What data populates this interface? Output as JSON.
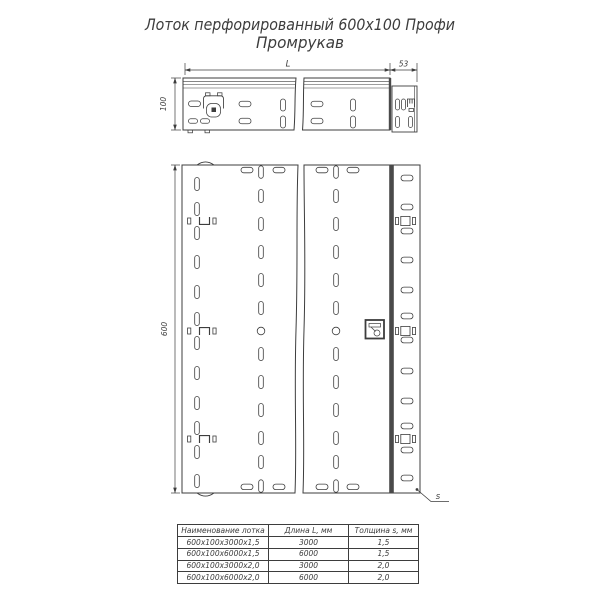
{
  "title": {
    "line1": "Лоток перфорированный 600х100 Профи",
    "line2": "Промрукав"
  },
  "dimensions": {
    "length_label": "L",
    "end_width": "53",
    "height": "100",
    "width": "600",
    "thickness_label": "s"
  },
  "table": {
    "headers": [
      "Наименование лотка",
      "Длина L, мм",
      "Толщина s, мм"
    ],
    "rows": [
      [
        "600х100х3000х1,5",
        "3000",
        "1,5"
      ],
      [
        "600х100х6000х1,5",
        "6000",
        "1,5"
      ],
      [
        "600х100х3000х2,0",
        "3000",
        "2,0"
      ],
      [
        "600х100х6000х2,0",
        "6000",
        "2,0"
      ]
    ]
  },
  "colors": {
    "line": "#3d3d3d",
    "band": "#4a4a4a",
    "background": "#ffffff"
  }
}
